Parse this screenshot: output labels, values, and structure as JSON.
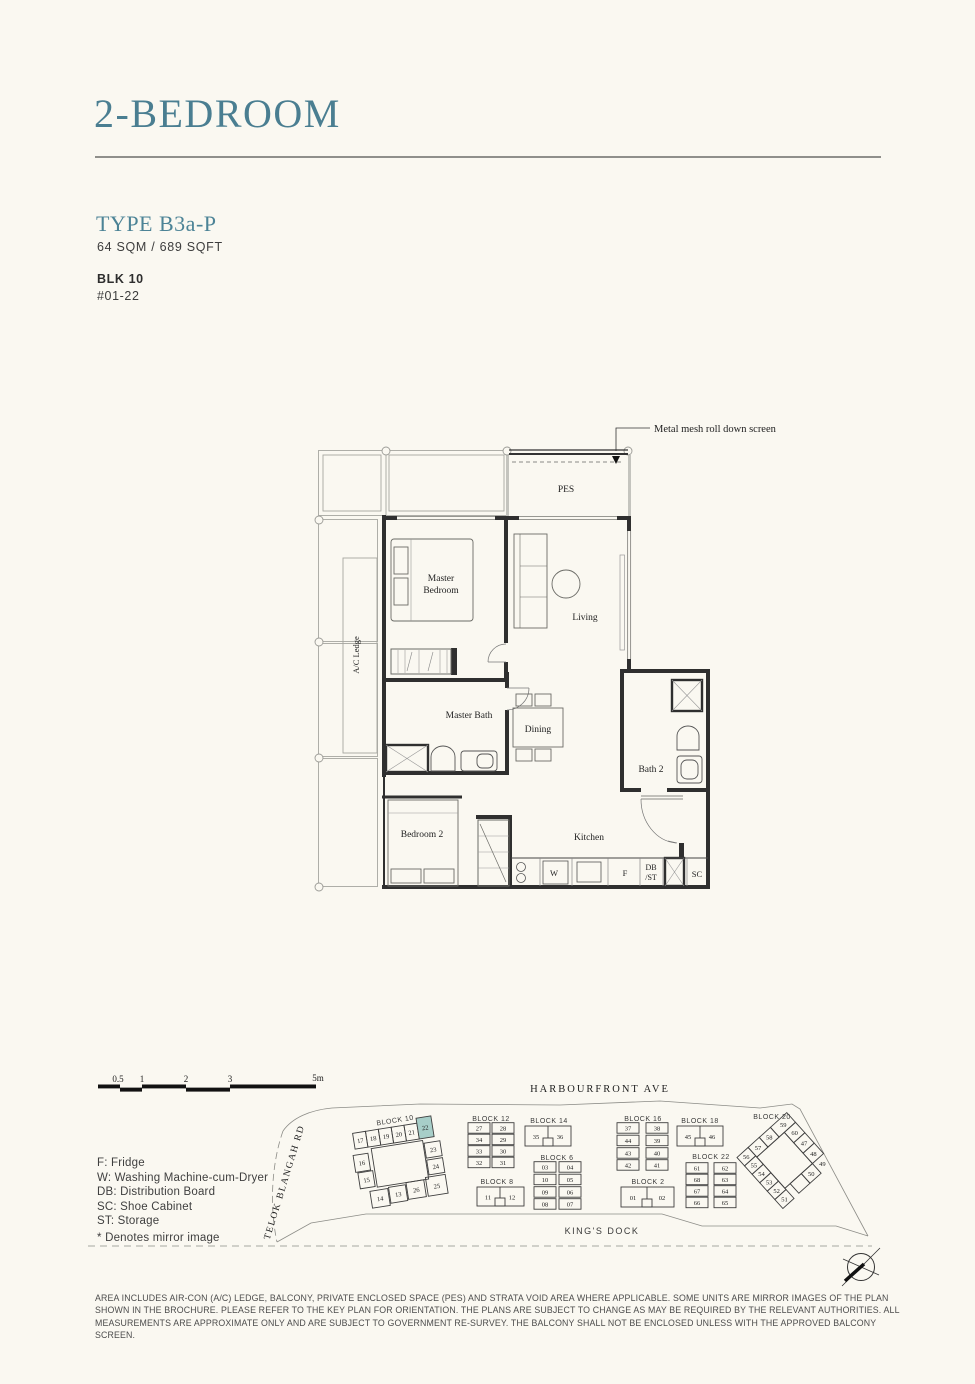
{
  "header": {
    "title": "2-BEDROOM",
    "type_label": "TYPE B3a-P",
    "area": "64 SQM / 689 SQFT",
    "block": "BLK 10",
    "unit": "#01-22"
  },
  "colors": {
    "accent_teal": "#4A7E91",
    "highlight_unit": "#A7CEC8",
    "background": "#FAF8F1"
  },
  "floor_plan": {
    "annotation": "Metal mesh roll down screen",
    "labels": {
      "pes": "PES",
      "master_bedroom_1": "Master",
      "master_bedroom_2": "Bedroom",
      "living": "Living",
      "ac_ledge": "A/C Ledge",
      "master_bath": "Master Bath",
      "dining": "Dining",
      "bath_2": "Bath 2",
      "bedroom_2": "Bedroom 2",
      "kitchen": "Kitchen",
      "washer": "W",
      "fridge": "F",
      "db": "DB",
      "st": "/ST",
      "sc": "SC"
    }
  },
  "scale_bar": {
    "ticks": [
      "0.5",
      "1",
      "2",
      "3",
      "5m"
    ]
  },
  "legend": {
    "items": [
      "F: Fridge",
      "W: Washing Machine-cum-Dryer",
      "DB: Distribution Board",
      "SC: Shoe Cabinet",
      "ST: Storage"
    ],
    "note": "* Denotes mirror image"
  },
  "key_plan": {
    "roads": {
      "top": "HARBOURFRONT AVE",
      "left": "TELOK BLANGAH RD",
      "bottom": "KING'S DOCK"
    },
    "highlighted_unit": "22",
    "blocks": [
      {
        "name": "BLOCK 10",
        "units": [
          "17",
          "18",
          "19",
          "20",
          "21",
          "22",
          "23",
          "24",
          "25",
          "26",
          "13",
          "14",
          "15",
          "16"
        ]
      },
      {
        "name": "BLOCK 12",
        "units": [
          "27",
          "28",
          "34",
          "29",
          "33",
          "30",
          "32",
          "31"
        ]
      },
      {
        "name": "BLOCK 14",
        "units": [
          "35",
          "36"
        ]
      },
      {
        "name": "BLOCK 16",
        "units": [
          "37",
          "38",
          "44",
          "39",
          "43",
          "40",
          "42",
          "41"
        ]
      },
      {
        "name": "BLOCK 18",
        "units": [
          "45",
          "46"
        ]
      },
      {
        "name": "BLOCK 20",
        "units": [
          "59",
          "57",
          "58",
          "60",
          "56",
          "55",
          "47",
          "54",
          "53",
          "48",
          "52",
          "49",
          "50",
          "51"
        ]
      },
      {
        "name": "BLOCK 6",
        "units": [
          "03",
          "04",
          "10",
          "05",
          "09",
          "06",
          "08",
          "07"
        ]
      },
      {
        "name": "BLOCK 8",
        "units": [
          "11",
          "12"
        ]
      },
      {
        "name": "BLOCK 2",
        "units": [
          "01",
          "02"
        ]
      },
      {
        "name": "BLOCK 22",
        "units": [
          "61",
          "62",
          "68",
          "63",
          "67",
          "64",
          "66",
          "65"
        ]
      }
    ]
  },
  "disclaimer": "AREA INCLUDES AIR-CON (A/C) LEDGE, BALCONY, PRIVATE ENCLOSED SPACE (PES) AND STRATA VOID AREA WHERE APPLICABLE. SOME UNITS ARE MIRROR IMAGES OF THE PLAN SHOWN IN THE BROCHURE. PLEASE REFER TO THE KEY PLAN FOR ORIENTATION. THE PLANS ARE SUBJECT TO CHANGE AS MAY BE REQUIRED BY THE RELEVANT AUTHORITIES. ALL MEASUREMENTS ARE APPROXIMATE ONLY AND ARE SUBJECT TO GOVERNMENT RE-SURVEY. THE BALCONY SHALL NOT BE ENCLOSED UNLESS WITH THE APPROVED BALCONY SCREEN."
}
